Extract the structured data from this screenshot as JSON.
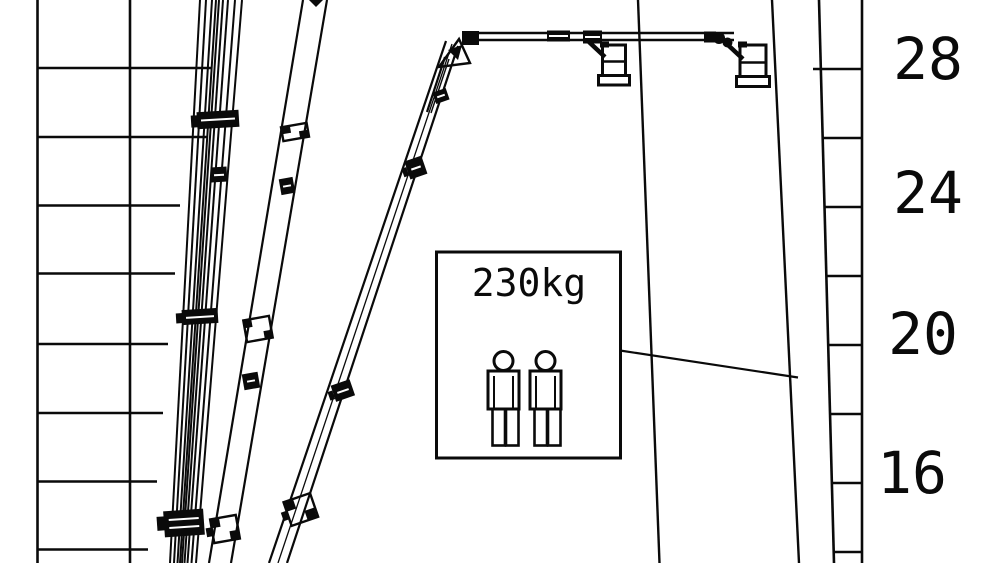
{
  "colors": {
    "ink": "#0a0a0a",
    "background": "#ffffff"
  },
  "load_box": {
    "label": "230kg",
    "person_icons": [
      "person-icon",
      "person-icon"
    ]
  },
  "height_scale": {
    "labels": [
      "28",
      "24",
      "20",
      "16"
    ]
  }
}
